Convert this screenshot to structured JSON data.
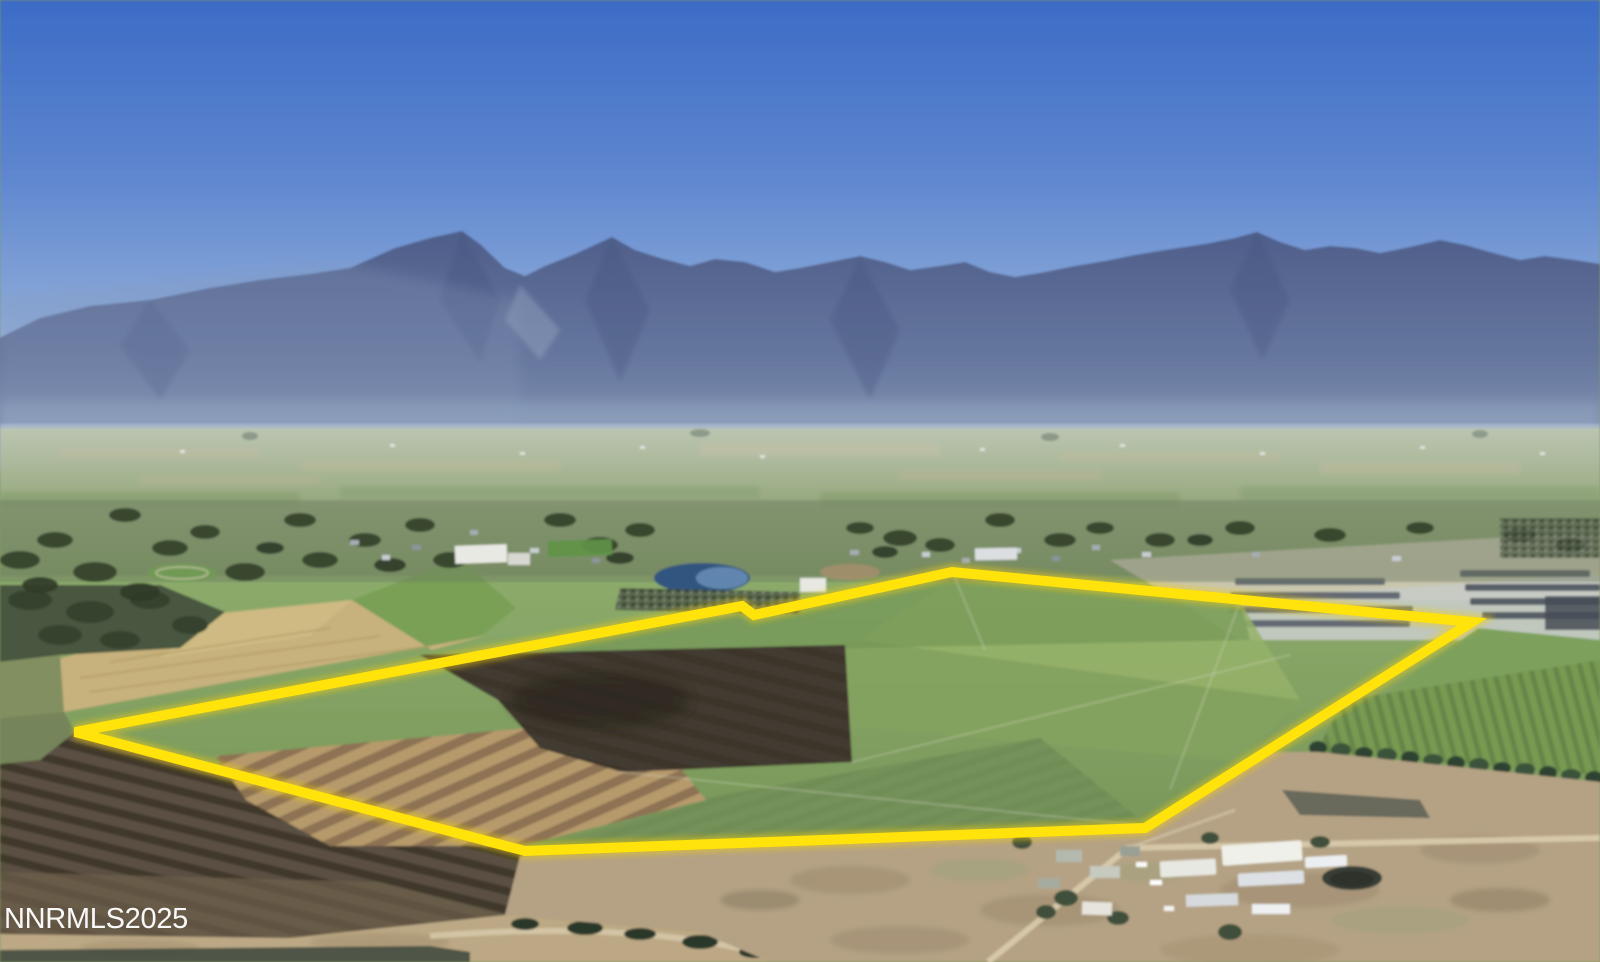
{
  "image": {
    "kind": "aerial-photo",
    "subject": "land-parcel-with-highlighted-boundary",
    "width": 1600,
    "height": 962
  },
  "watermark": {
    "text": "NNRMLS2025",
    "color": "#ffffff"
  },
  "boundary": {
    "label": "property-boundary",
    "color": "#ffe30a",
    "points": "75,732 742,606 754,615 952,572 1472,622 1145,828 525,851"
  },
  "palette": {
    "sky_top": "#3c6cc6",
    "sky_horizon": "#b0c6e2",
    "mountains": "#57679a",
    "valley_haze": "#a9b492",
    "field_green": "#7e9c5d",
    "field_wheat": "#c7b17b",
    "field_plowed_dark": "#3b342b",
    "field_rows_tan": "#b69a6c",
    "scrub": "#b5a284",
    "road": "#d8cbac",
    "lake": "#33557f"
  }
}
